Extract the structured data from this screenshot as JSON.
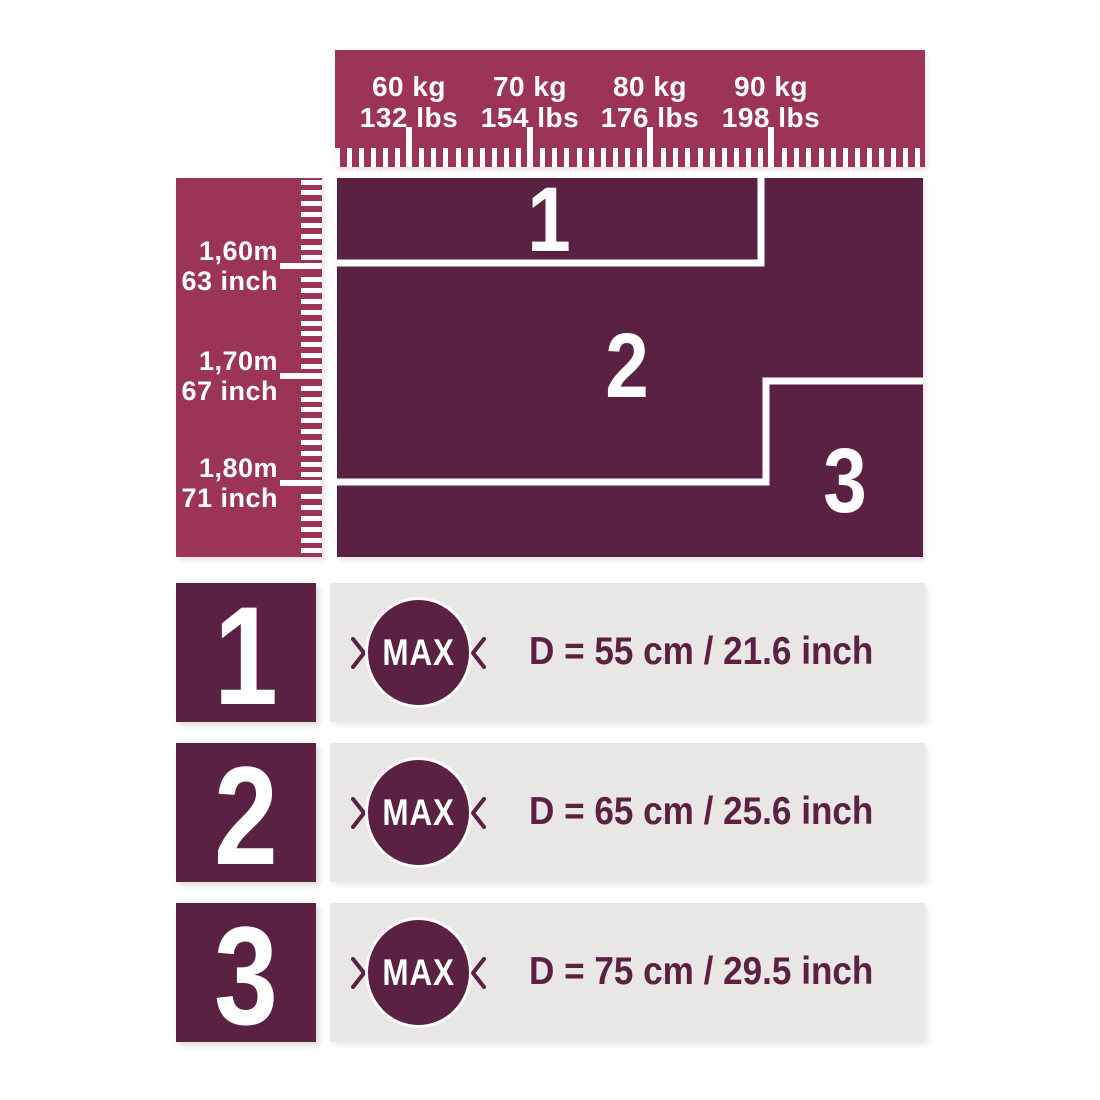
{
  "colors": {
    "ruler_raspberry": "#9c3456",
    "zone_plum": "#5b2143",
    "row_bar_gray": "#e9e7e5",
    "text_on_dark": "#ffffff"
  },
  "chart_data": {
    "type": "heatmap",
    "title": "",
    "x_axis": {
      "ticks": [
        {
          "primary": "60 kg",
          "secondary": "132 lbs"
        },
        {
          "primary": "70 kg",
          "secondary": "154 lbs"
        },
        {
          "primary": "80 kg",
          "secondary": "176 lbs"
        },
        {
          "primary": "90 kg",
          "secondary": "198 lbs"
        }
      ],
      "minor_tick_step": "1 kg"
    },
    "y_axis": {
      "ticks": [
        {
          "primary": "1,60m",
          "secondary": "63 inch"
        },
        {
          "primary": "1,70m",
          "secondary": "67 inch"
        },
        {
          "primary": "1,80m",
          "secondary": "71 inch"
        }
      ],
      "minor_tick_step": "1 cm"
    },
    "zones": [
      {
        "label": "1",
        "region": "height up to 1,60m and weight up to ~90 kg"
      },
      {
        "label": "2",
        "region": "height 1,60m to 1,80m, or any height up to 1,70m above ~90 kg"
      },
      {
        "label": "3",
        "region": "height above 1,80m, or above 1,70m when weight above ~90 kg"
      }
    ]
  },
  "size_rows": [
    {
      "size": "1",
      "badge": "MAX",
      "diameter": "D = 55 cm / 21.6 inch"
    },
    {
      "size": "2",
      "badge": "MAX",
      "diameter": "D = 65 cm / 25.6 inch"
    },
    {
      "size": "3",
      "badge": "MAX",
      "diameter": "D = 75 cm / 29.5 inch"
    }
  ]
}
